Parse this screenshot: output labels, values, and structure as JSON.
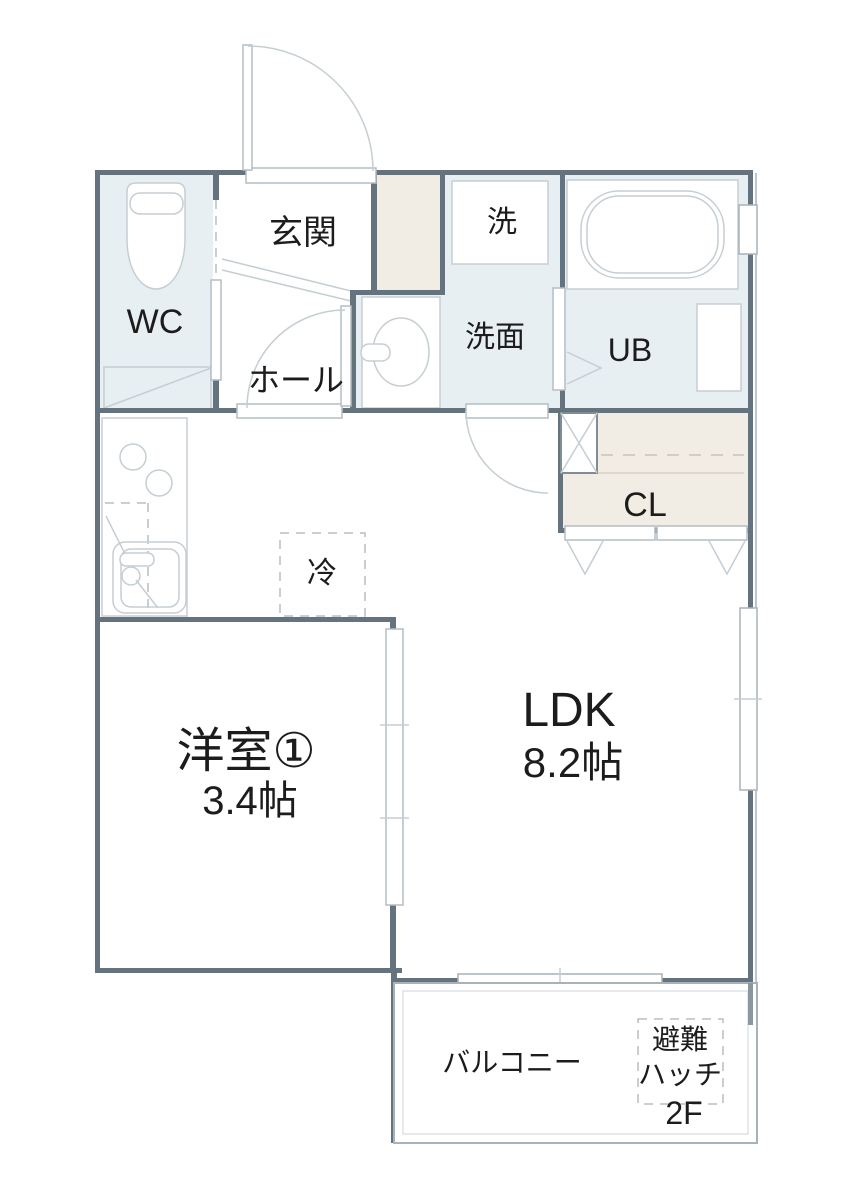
{
  "plan": {
    "rooms": {
      "wc": "WC",
      "entrance": "玄関",
      "hall": "ホール",
      "laundry": "洗",
      "washroom": "洗面",
      "bath": "UB",
      "closet": "CL",
      "refrigerator": "冷",
      "western_room": {
        "name": "洋室①",
        "area": "3.4帖"
      },
      "ldk": {
        "name": "LDK",
        "area": "8.2帖"
      },
      "balcony": "バルコニー",
      "hatch": {
        "line1": "避難",
        "line2": "ハッチ",
        "floor": "2F"
      }
    },
    "colors": {
      "wall": "#64737d",
      "wet_area_fill": "#e8eff3",
      "storage_fill": "#f2ede4",
      "fixture_stroke": "#c5ced3",
      "text": "#1c1c1c"
    }
  }
}
